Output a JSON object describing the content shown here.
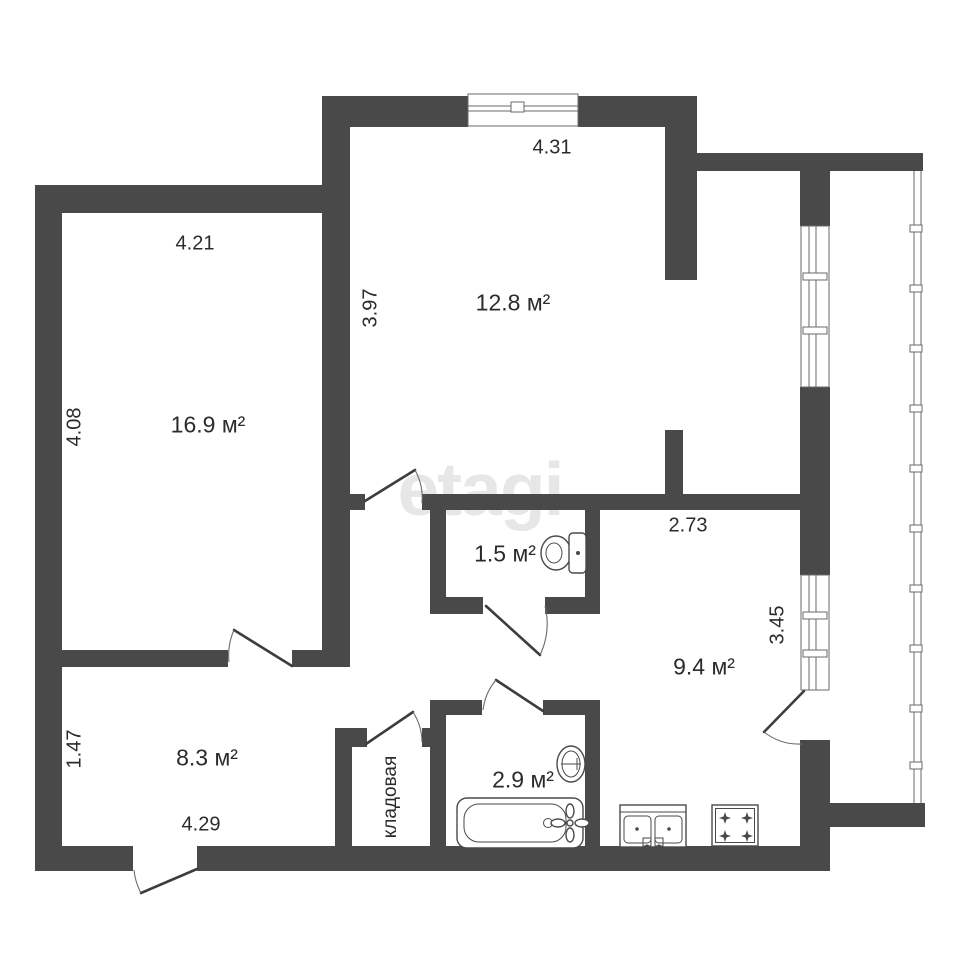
{
  "watermark": {
    "text": "etagi"
  },
  "colors": {
    "wall": "#494949",
    "fixture_line": "#4a4a4a",
    "text": "#2b2b2b",
    "watermark": "#e7e7e7",
    "background": "#ffffff"
  },
  "rooms": {
    "living": {
      "area": "16.9 м²",
      "width_m": "4.21",
      "height_m": "4.08"
    },
    "bedroom": {
      "area": "12.8 м²",
      "width_m": "4.31",
      "height_m": "3.97"
    },
    "wc": {
      "area": "1.5 м²"
    },
    "kitchen": {
      "area": "9.4 м²",
      "width_m": "2.73",
      "height_m": "3.45"
    },
    "hallway": {
      "area": "8.3 м²",
      "width_m": "4.29",
      "height_m": "1.47"
    },
    "bathroom": {
      "area": "2.9 м²"
    },
    "storage": {
      "label": "кладовая"
    }
  },
  "fixtures": {
    "wc": "toilet",
    "bathroom": [
      "bathtub",
      "washbasin"
    ],
    "kitchen": [
      "double-sink",
      "gas-stove"
    ]
  }
}
